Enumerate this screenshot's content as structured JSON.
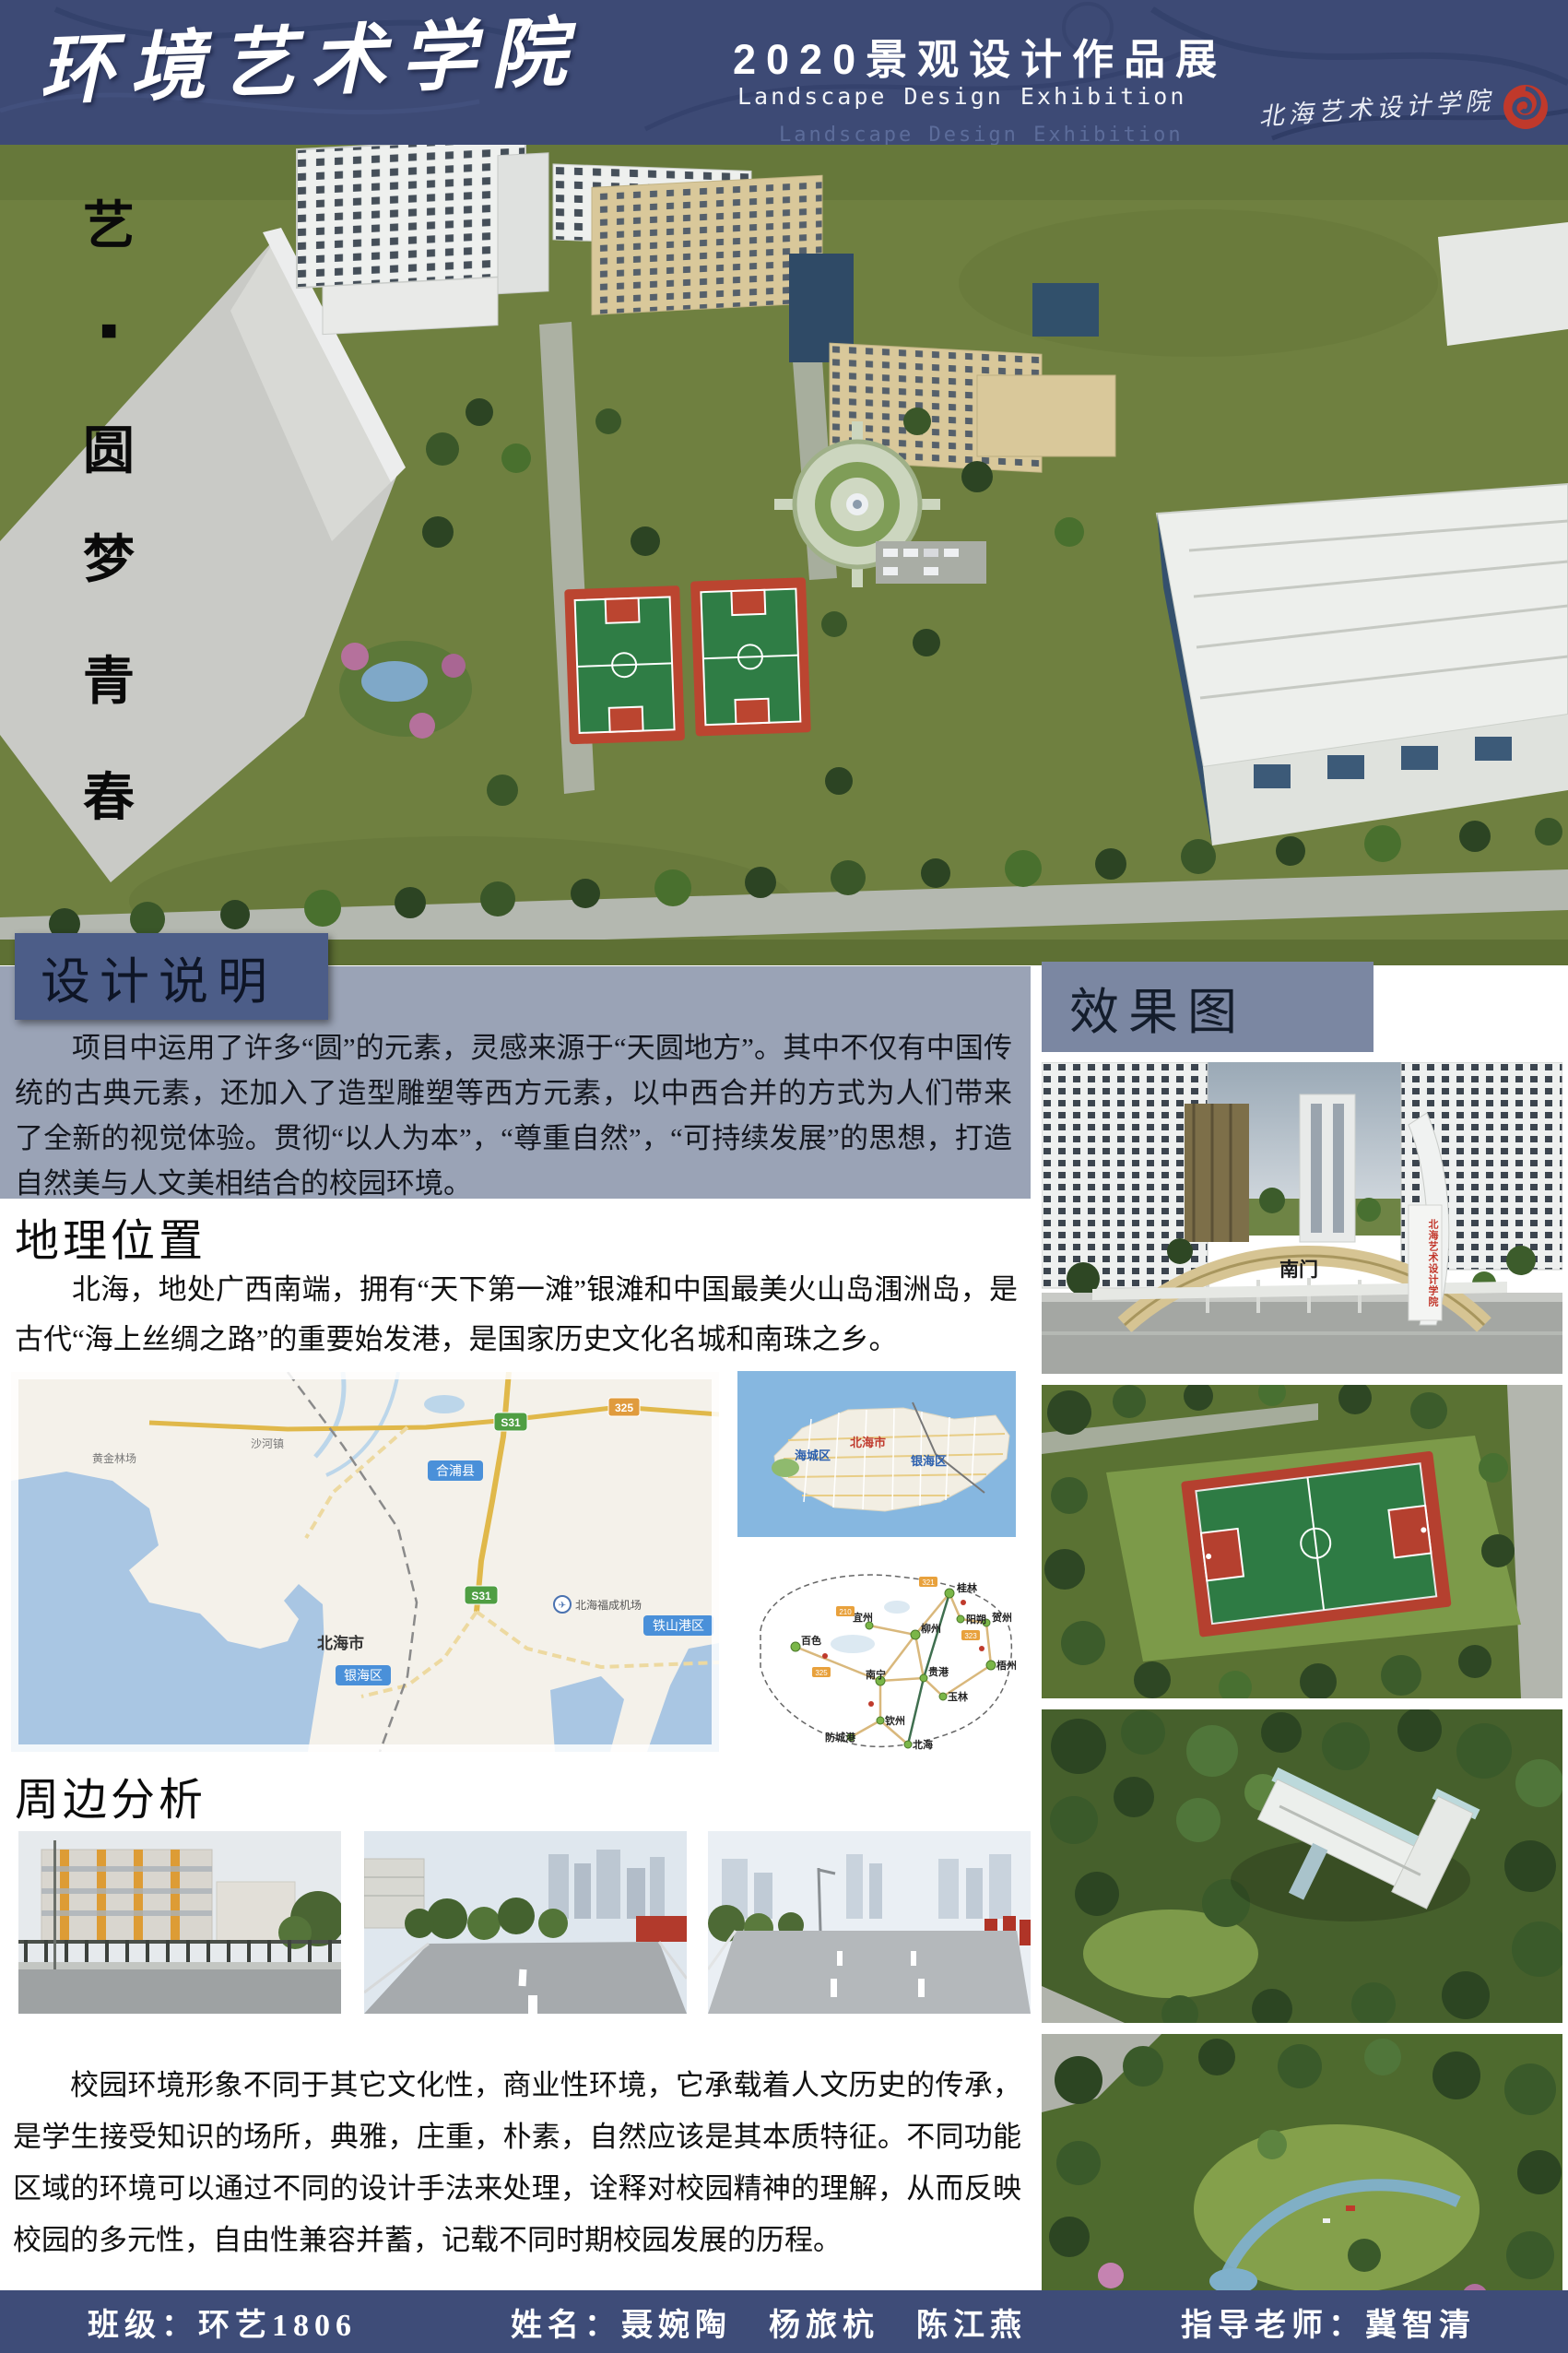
{
  "header": {
    "school_title": "环境艺术学院",
    "exhibition_title": "2020景观设计作品展",
    "exhibition_subtitle": "Landscape Design Exhibition",
    "institute_seal": "北海艺术设计学院"
  },
  "hero": {
    "vertical_title": [
      "艺",
      "■",
      "圆",
      "梦",
      "青",
      "春"
    ]
  },
  "design_note": {
    "title": "设计说明",
    "body": "项目中运用了许多“圆”的元素，灵感来源于“天圆地方”。其中不仅有中国传统的古典元素，还加入了造型雕塑等西方元素，以中西合并的方式为人们带来了全新的视觉体验。贯彻“以人为本”，“尊重自然”，“可持续发展”的思想，打造自然美与人文美相结合的校园环境。"
  },
  "location": {
    "title": "地理位置",
    "body": "北海，地处广西南端，拥有“天下第一滩”银滩和中国最美火山岛涠洲岛，是古代“海上丝绸之路”的重要始发港，是国家历史文化名城和南珠之乡。"
  },
  "maps": {
    "region": {
      "city_label": "北海市",
      "county_label": "合浦县",
      "yinhai_label": "银海区",
      "tieshangang_label": "铁山港区",
      "airport_label": "北海福成机场",
      "road_s31": "S31",
      "road_325": "325",
      "farm_label": "黄金林场",
      "town_label": "沙河镇"
    },
    "city": {
      "haicheng": "海城区",
      "beihai": "北海市",
      "yinhai": "银海区"
    },
    "province": {
      "cities": [
        "桂林",
        "阳朔",
        "柳州",
        "贺州",
        "梧州",
        "宜州",
        "百色",
        "南宁",
        "贵港",
        "玉林",
        "钦州",
        "防城港",
        "北海"
      ],
      "tags": [
        "321",
        "323",
        "210",
        "325"
      ]
    }
  },
  "surroundings": {
    "title": "周边分析"
  },
  "renderings": {
    "title": "效果图",
    "gate_sign": "南门",
    "gate_tower": "北海艺术设计学院"
  },
  "conclusion": {
    "body": "校园环境形象不同于其它文化性，商业性环境，它承载着人文历史的传承，是学生接受知识的场所，典雅，庄重，朴素，自然应该是其本质特征。不同功能区域的环境可以通过不同的设计手法来处理，诠释对校园精神的理解，从而反映校园的多元性，自由性兼容并蓄，记载不同时期校园发展的历程。"
  },
  "footer": {
    "class_label": "班级：环艺1806",
    "names_label": "姓名：聂婉陶　杨旅杭　陈江燕",
    "advisor_label": "指导老师：冀智清"
  },
  "colors": {
    "header_navy": "#3d4a75",
    "panel_blue": "#9aa3b6",
    "note_box_blue": "#4c5d88",
    "fx_box_blue": "#7b87a2",
    "footer_navy": "#3e4c78",
    "seal_red": "#c0392b",
    "grass_green": "#6f8040",
    "court_red": "#b5402f",
    "sea_blue": "#a9c6e3"
  }
}
